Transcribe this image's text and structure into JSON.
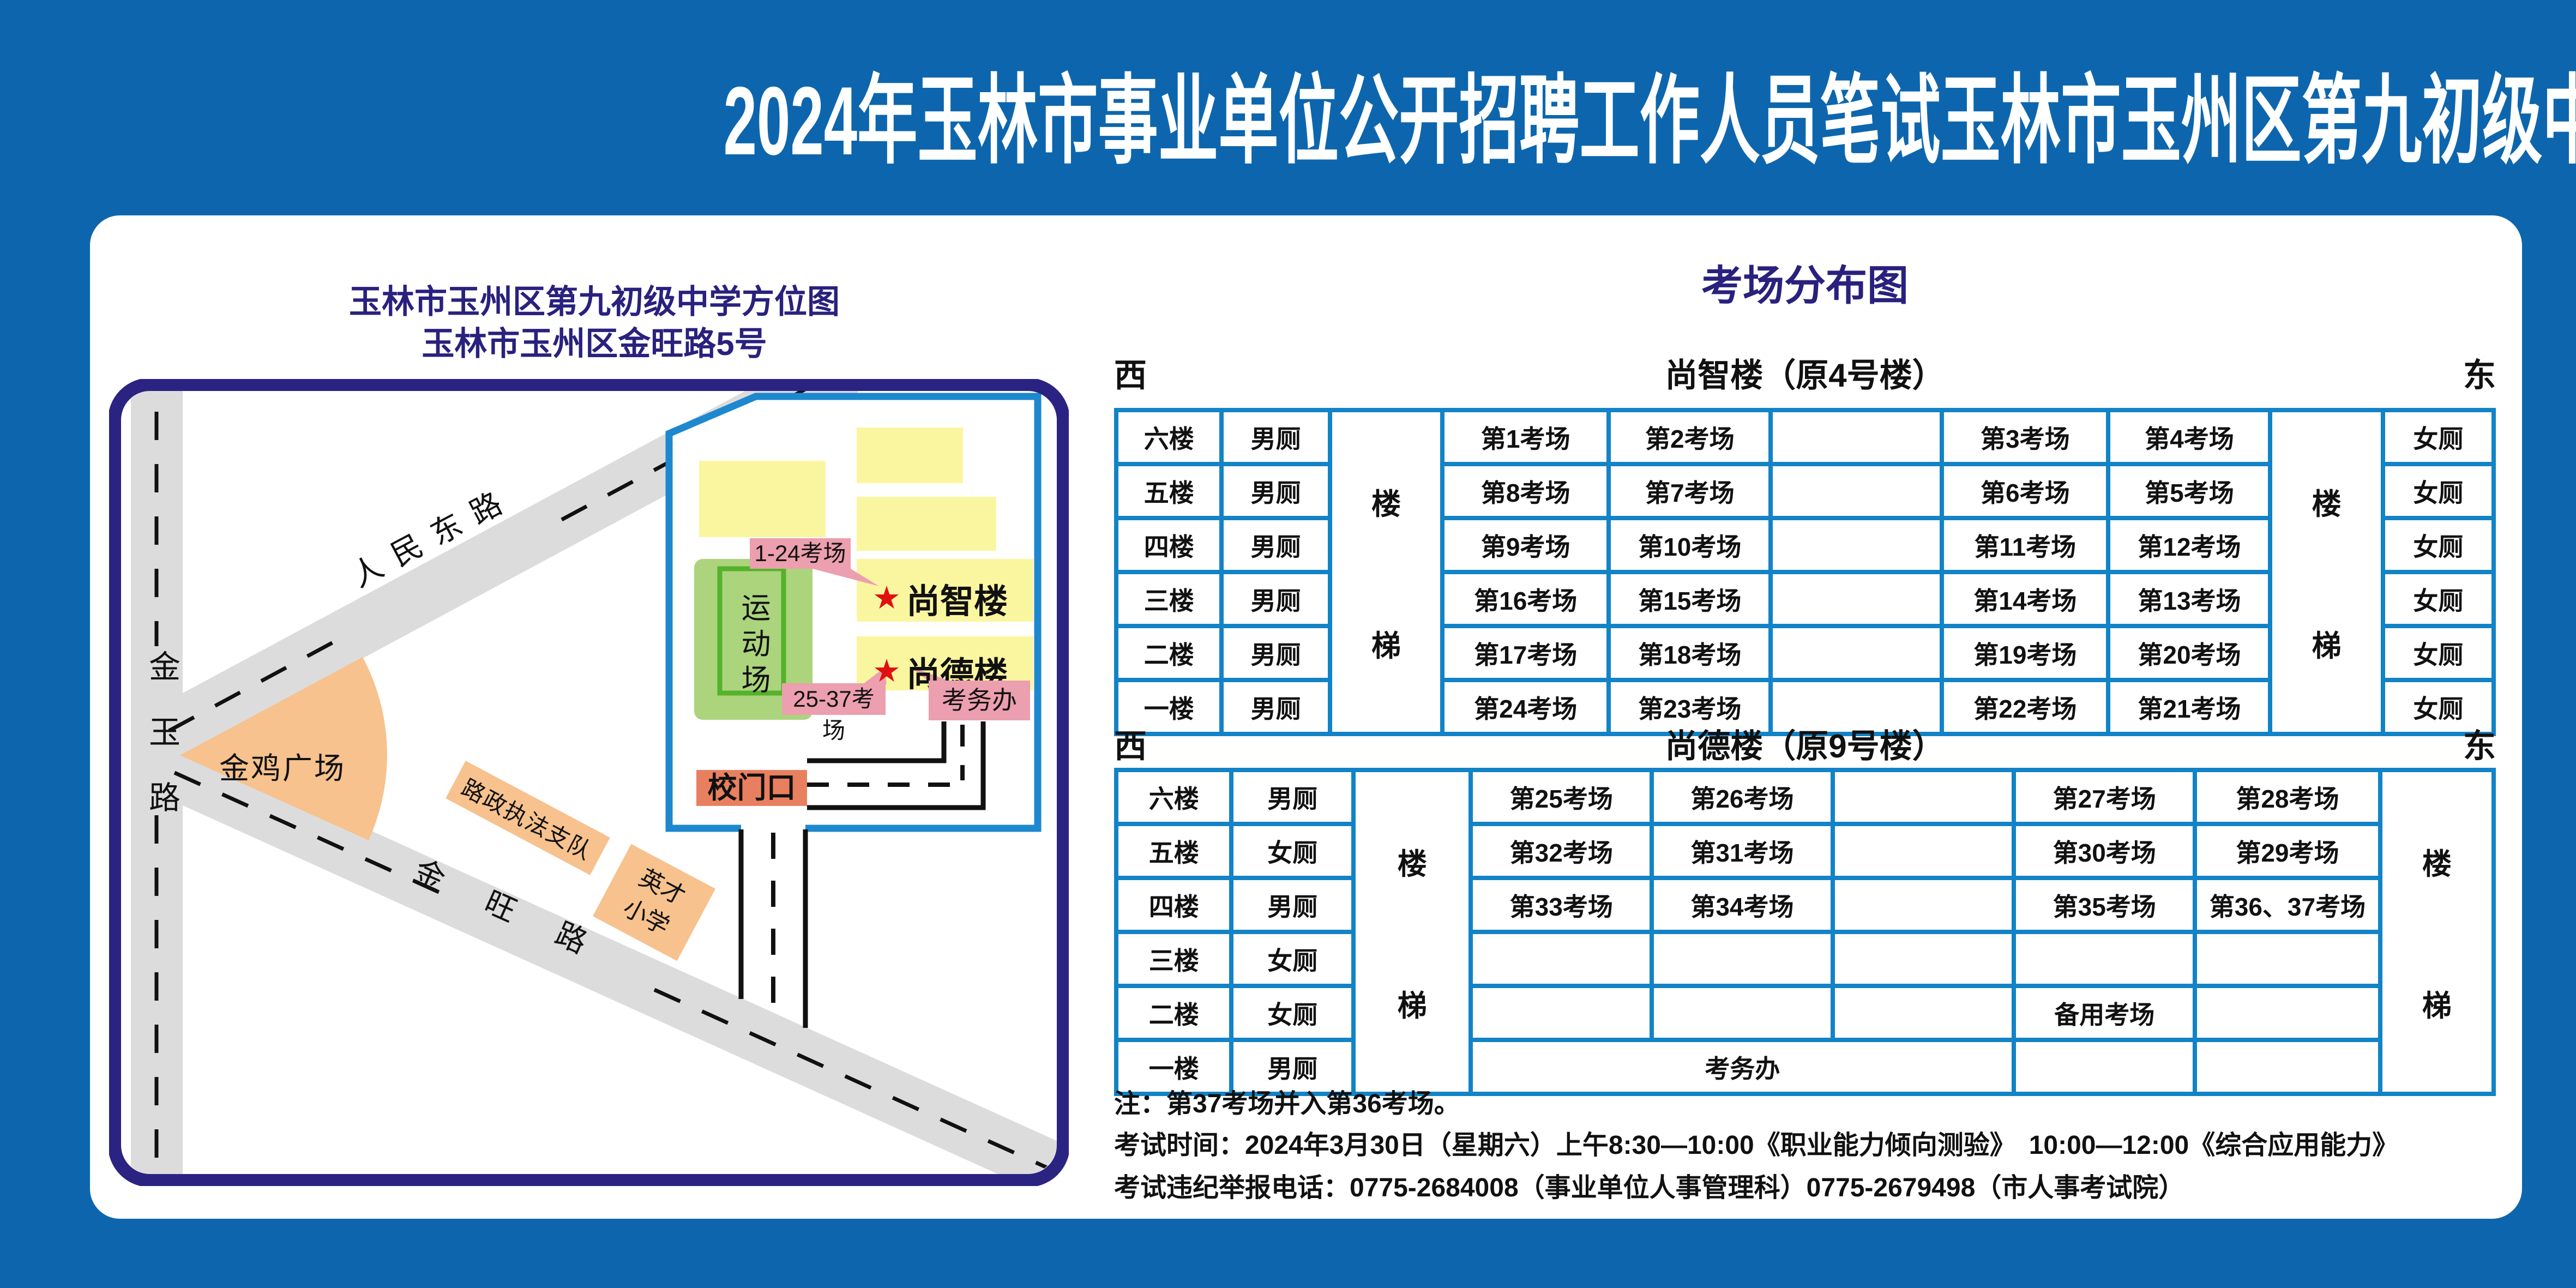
{
  "title": "2024年玉林市事业单位公开招聘工作人员笔试玉林市玉州区第九初级中学考点考场示意图",
  "map": {
    "title_line1": "玉林市玉州区第九初级中学方位图",
    "title_line2": "玉林市玉州区金旺路5号",
    "labels": {
      "renmin_east_road": "人民东路",
      "jinyu_road": "金玉路",
      "jinwang_road": "金旺路",
      "jinji_square": "金鸡广场",
      "road_admin": "路政执法支队",
      "yingcai_school": "英才小学",
      "sports_field": "运动场",
      "shangzhi_building": "尚智楼",
      "shangde_building": "尚德楼",
      "rooms_1_24": "1-24考场",
      "rooms_25_37": "25-37考场",
      "exam_office": "考务办",
      "school_gate": "校门口",
      "star": "★"
    }
  },
  "dist": {
    "title": "考场分布图",
    "west": "西",
    "east": "东",
    "stairs": {
      "upper": "楼",
      "lower": "梯"
    },
    "b1": {
      "name": "尚智楼（原4号楼）",
      "rows": [
        {
          "floor": "六楼",
          "wc": "男厕",
          "a": "第1考场",
          "b": "第2考场",
          "mid": "",
          "c": "第3考场",
          "d": "第4考场",
          "wc2": "女厕"
        },
        {
          "floor": "五楼",
          "wc": "男厕",
          "a": "第8考场",
          "b": "第7考场",
          "mid": "",
          "c": "第6考场",
          "d": "第5考场",
          "wc2": "女厕"
        },
        {
          "floor": "四楼",
          "wc": "男厕",
          "a": "第9考场",
          "b": "第10考场",
          "mid": "",
          "c": "第11考场",
          "d": "第12考场",
          "wc2": "女厕"
        },
        {
          "floor": "三楼",
          "wc": "男厕",
          "a": "第16考场",
          "b": "第15考场",
          "mid": "",
          "c": "第14考场",
          "d": "第13考场",
          "wc2": "女厕"
        },
        {
          "floor": "二楼",
          "wc": "男厕",
          "a": "第17考场",
          "b": "第18考场",
          "mid": "",
          "c": "第19考场",
          "d": "第20考场",
          "wc2": "女厕"
        },
        {
          "floor": "一楼",
          "wc": "男厕",
          "a": "第24考场",
          "b": "第23考场",
          "mid": "",
          "c": "第22考场",
          "d": "第21考场",
          "wc2": "女厕"
        }
      ]
    },
    "b2": {
      "name": "尚德楼（原9号楼）",
      "rows": [
        {
          "floor": "六楼",
          "wc": "男厕",
          "a": "第25考场",
          "b": "第26考场",
          "mid": "",
          "c": "第27考场",
          "d": "第28考场"
        },
        {
          "floor": "五楼",
          "wc": "女厕",
          "a": "第32考场",
          "b": "第31考场",
          "mid": "",
          "c": "第30考场",
          "d": "第29考场"
        },
        {
          "floor": "四楼",
          "wc": "男厕",
          "a": "第33考场",
          "b": "第34考场",
          "mid": "",
          "c": "第35考场",
          "d": "第36、37考场"
        },
        {
          "floor": "三楼",
          "wc": "女厕",
          "a": "",
          "b": "",
          "mid": "",
          "c": "",
          "d": ""
        },
        {
          "floor": "二楼",
          "wc": "女厕",
          "a": "",
          "b": "",
          "mid": "",
          "c": "备用考场",
          "d": ""
        },
        {
          "floor": "一楼",
          "wc": "男厕",
          "office": "考务办",
          "c": "",
          "d": ""
        }
      ]
    }
  },
  "notes": [
    "注：第37考场并入第36考场。",
    "考试时间：2024年3月30日（星期六）上午8:30—10:00《职业能力倾向测验》　10:00—12:00《综合应用能力》",
    "考试违纪举报电话：0775-2684008（事业单位人事管理科）0775-2679498（市人事考试院）"
  ],
  "colors": {
    "background_blue": "#0d66ad",
    "navy": "#29217d",
    "map_border_navy": "#2b2382",
    "table_border_blue": "#1283c6",
    "campus_border_blue": "#1e88cf",
    "building_yellow": "#faf6a0",
    "field_green": "#abd47d",
    "field_border_green": "#55b22b",
    "road_gray": "#dcdcdc",
    "plaza_orange": "#f7c28d",
    "callout_pink": "#ec9fae",
    "gate_salmon": "#e8805f",
    "star_red": "#e01010",
    "title_white": "#ffffff"
  }
}
